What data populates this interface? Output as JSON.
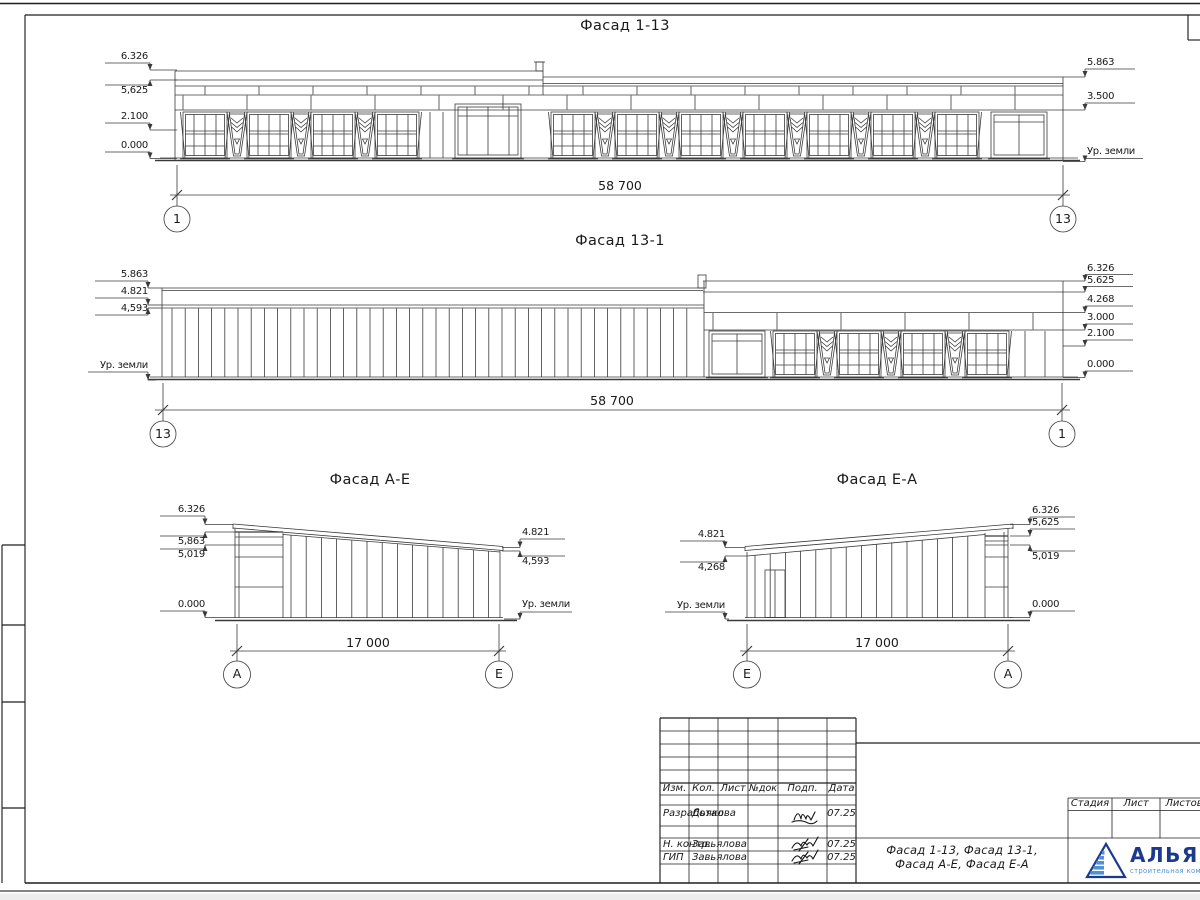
{
  "facades": {
    "f113": {
      "title": "Фасад 1-13",
      "dim": "58 700",
      "axisL": "1",
      "axisR": "13",
      "marks": {
        "l1": "6.326",
        "l2": "5,625",
        "l3": "2.100",
        "l4": "0.000",
        "r1": "5.863",
        "r2": "3.500",
        "r3": "Ур. земли"
      }
    },
    "f131": {
      "title": "Фасад 13-1",
      "dim": "58 700",
      "axisL": "13",
      "axisR": "1",
      "marks": {
        "l1": "5.863",
        "l2": "4.821",
        "l3": "4,593",
        "l4": "Ур. земли",
        "r1": "6.326",
        "r2": "5.625",
        "r3": "4.268",
        "r4": "3.000",
        "r5": "2.100",
        "r6": "0.000"
      }
    },
    "fae": {
      "title": "Фасад А-Е",
      "dim": "17 000",
      "axisL": "А",
      "axisR": "Е",
      "marks": {
        "l1": "6.326",
        "l2": "5,863",
        "l3": "5,019",
        "l4": "0.000",
        "r1": "4.821",
        "r2": "4,593",
        "r3": "Ур. земли"
      }
    },
    "fea": {
      "title": "Фасад Е-А",
      "dim": "17 000",
      "axisL": "Е",
      "axisR": "А",
      "marks": {
        "l1": "4.821",
        "l2": "4,268",
        "l3": "Ур. земли",
        "r1": "6.326",
        "r2": "5,625",
        "r3": "5,019",
        "r4": "0.000"
      }
    }
  },
  "title_block": {
    "rev_headers": [
      "Изм.",
      "Кол.",
      "Лист",
      "№док",
      "Подп.",
      "Дата"
    ],
    "sign_rows": [
      {
        "role": "Разработал",
        "name": "Дьякова",
        "date": "07.25"
      },
      {
        "role": "Н. контр.",
        "name": "Завьялова",
        "date": "07.25"
      },
      {
        "role": "ГИП",
        "name": "Завьялова",
        "date": "07.25"
      }
    ],
    "doc_name_line1": "Фасад 1-13, Фасад 13-1,",
    "doc_name_line2": "Фасад А-Е, Фасад Е-А",
    "stage_headers": [
      "Стадия",
      "Лист",
      "Листов"
    ],
    "company": {
      "name": "АЛЬЯНС",
      "tagline": "строительная компания"
    },
    "colors": {
      "logo_dark": "#1c3a8c",
      "logo_light": "#4f93d6"
    }
  }
}
